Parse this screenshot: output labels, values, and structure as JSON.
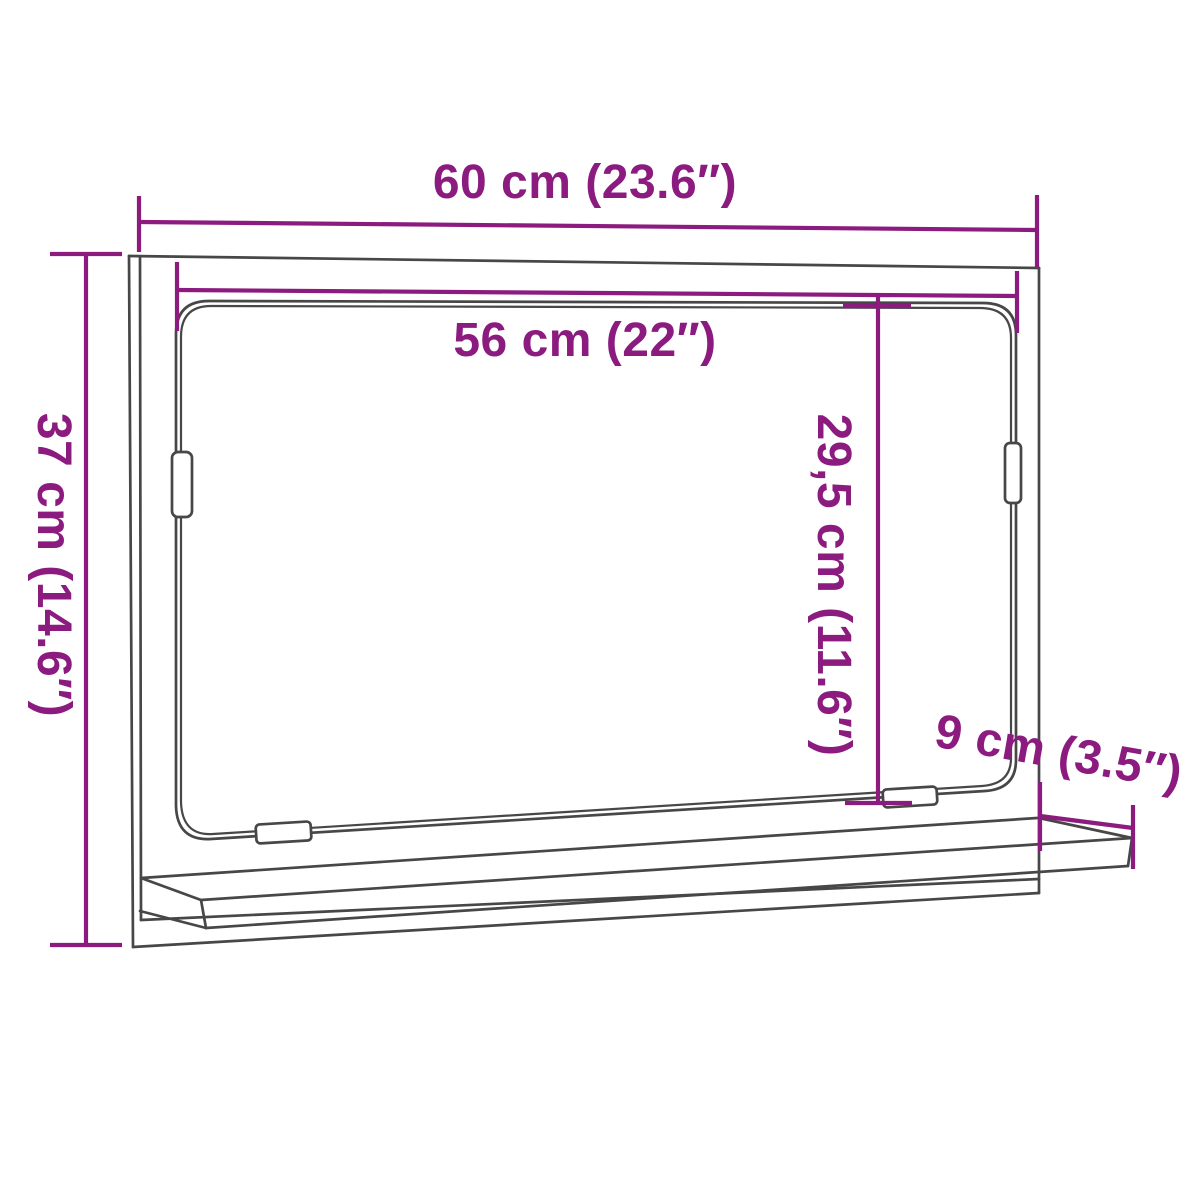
{
  "diagram": {
    "colors": {
      "dimension": "#8C1B80",
      "outline": "#474747",
      "background": "#FFFFFF"
    },
    "dimensions": [
      {
        "id": "cabinet-width",
        "label": "60 cm (23.6″)",
        "cm": "60",
        "inches": "23.6"
      },
      {
        "id": "mirror-width",
        "label": "56 cm (22″)",
        "cm": "56",
        "inches": "22"
      },
      {
        "id": "cabinet-height",
        "label": "37 cm (14.6″)",
        "cm": "37",
        "inches": "14.6"
      },
      {
        "id": "mirror-height",
        "label": "29,5 cm (11.6″)",
        "cm": "29,5",
        "inches": "11.6"
      },
      {
        "id": "shelf-depth",
        "label": "9 cm (3.5″)",
        "cm": "9",
        "inches": "3.5"
      }
    ]
  }
}
